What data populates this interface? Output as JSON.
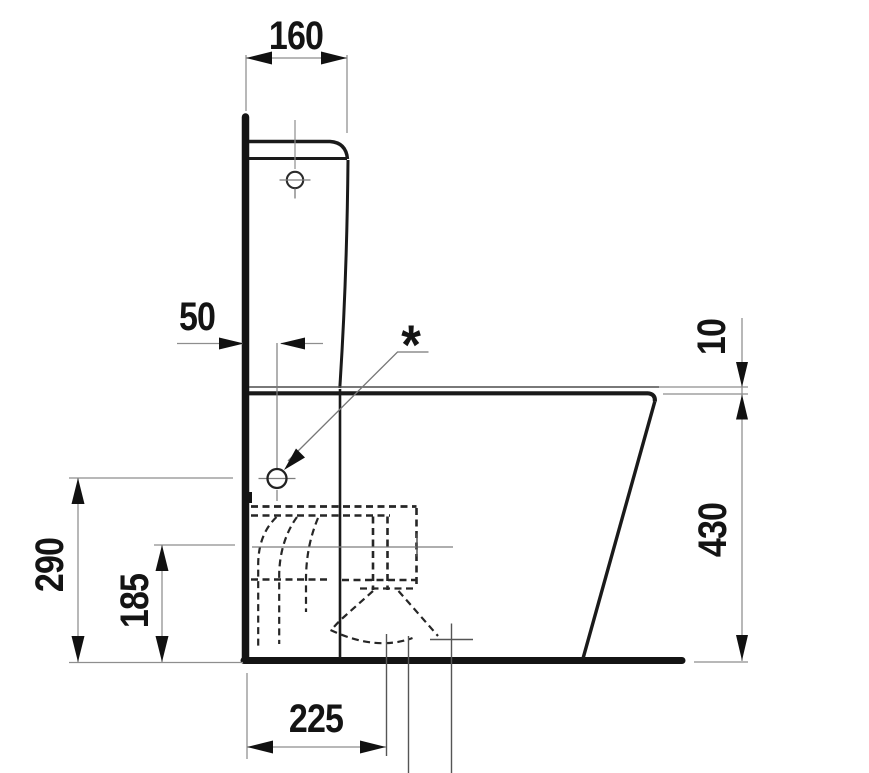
{
  "diagram": {
    "labels": {
      "cistern_width_mm": "160",
      "hole_centre_offset_mm": "50",
      "note_marker": "*",
      "seat_to_rim_gap_mm": "10",
      "rim_height_mm": "430",
      "inlet_centre_height_mm": "290",
      "outlet_centre_height_mm": "185",
      "outlet_centre_from_wall_mm": "225"
    },
    "colors": {
      "line": "#141414",
      "thin_line": "#8e8e8e",
      "hidden_dash": "#262626",
      "background": "#ffffff"
    }
  }
}
